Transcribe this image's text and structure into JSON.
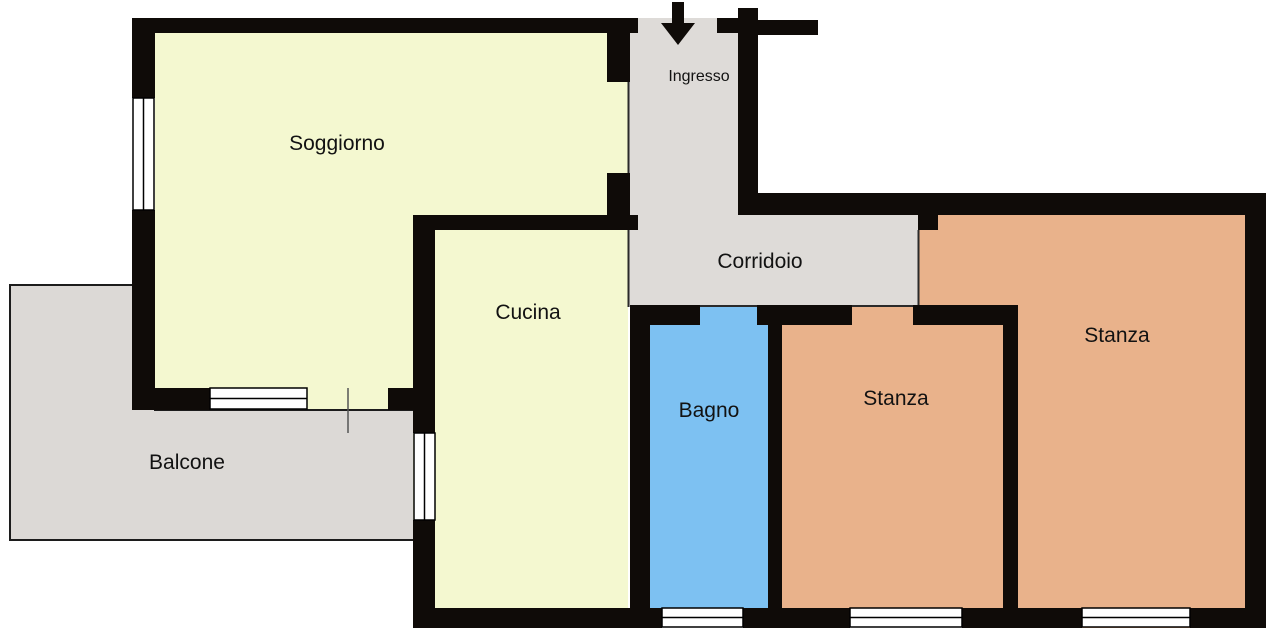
{
  "plan": {
    "type": "apartment-floor-plan",
    "rooms": {
      "soggiorno": {
        "label": "Soggiorno"
      },
      "cucina": {
        "label": "Cucina"
      },
      "ingresso": {
        "label": "Ingresso"
      },
      "corridoio": {
        "label": "Corridoio"
      },
      "bagno": {
        "label": "Bagno"
      },
      "stanza_middle": {
        "label": "Stanza"
      },
      "stanza_right": {
        "label": "Stanza"
      },
      "balcone": {
        "label": "Balcone"
      }
    },
    "colors": {
      "living_yellow": "#f4f8d0",
      "circulation_gray": "#dedbd8",
      "balcony_gray": "#dcd9d6",
      "bath_blue": "#7dc1f2",
      "bedroom_orange": "#e9b28b",
      "wall_black": "#0f0b08",
      "window_white": "#ffffff",
      "outline_dark": "#1c1c1c",
      "door_line_gray": "#555555",
      "background": "#ffffff"
    },
    "symbols": {
      "entrance_arrow": "down-arrow at main entrance"
    }
  }
}
